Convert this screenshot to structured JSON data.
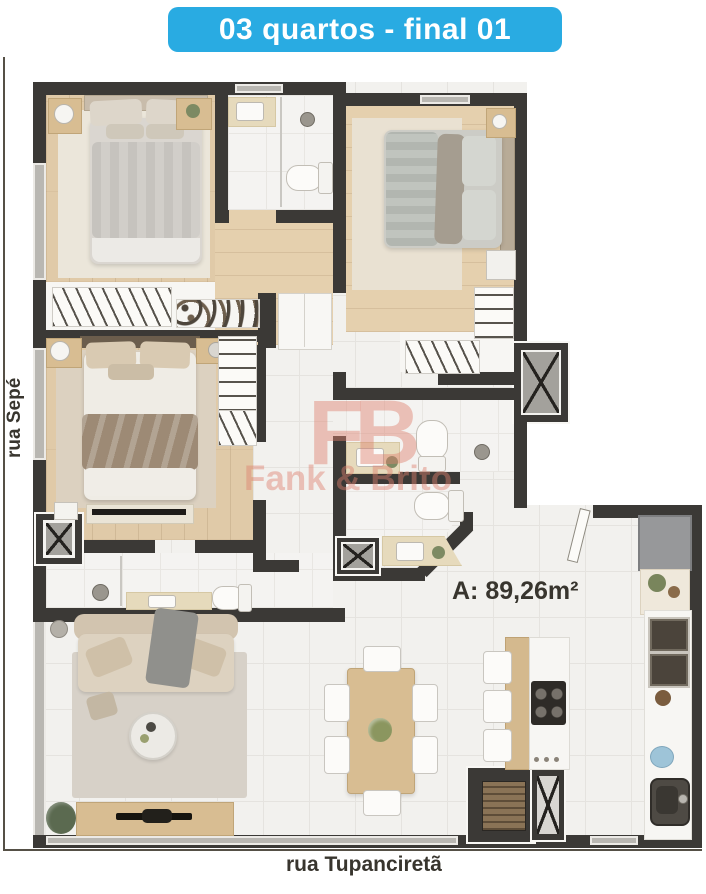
{
  "title": {
    "label": "03 quartos - final 01"
  },
  "streets": {
    "left": "rua Sepé",
    "bottom": "rua Tupanciretã"
  },
  "area": {
    "label": "A: 89,26m²"
  },
  "watermark": {
    "monogram": "FB",
    "name": "Fank & Brito"
  },
  "colors": {
    "banner_bg": "#29abe2",
    "banner_text": "#ffffff",
    "wall": "#3b3936",
    "wood_floor": "#e0caa8",
    "tile_floor": "#f2f1ee",
    "label_text": "#38352e",
    "watermark_pink": "#dd806e"
  }
}
